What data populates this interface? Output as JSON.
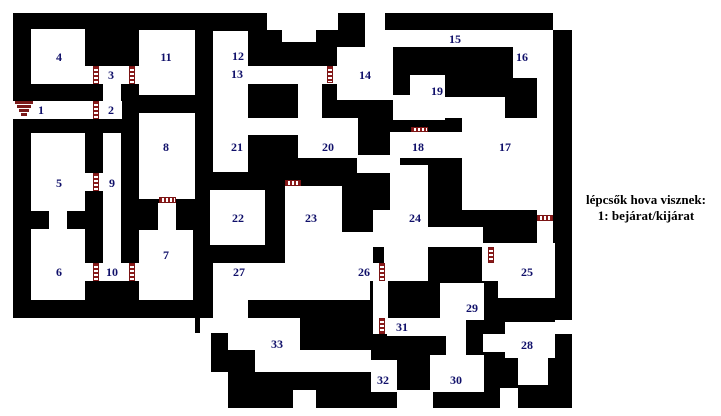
{
  "map": {
    "wall_color": "#000000",
    "floor_color": "#ffffff",
    "label_color": "#10106a",
    "door_color": "#8b1a1a",
    "stairs_color": "#7a1a1a",
    "walls": [
      [
        13,
        13,
        559,
        305
      ],
      [
        195,
        318,
        377,
        54
      ],
      [
        228,
        372,
        344,
        36
      ]
    ],
    "floors": [
      [
        31,
        29,
        54,
        55
      ],
      [
        85,
        66,
        54,
        18
      ],
      [
        103,
        84,
        18,
        18
      ],
      [
        13,
        101,
        109,
        18
      ],
      [
        139,
        30,
        56,
        65
      ],
      [
        139,
        113,
        56,
        86
      ],
      [
        158,
        203,
        18,
        27
      ],
      [
        31,
        133,
        54,
        78
      ],
      [
        49,
        211,
        18,
        18
      ],
      [
        31,
        229,
        54,
        71
      ],
      [
        103,
        133,
        18,
        148
      ],
      [
        85,
        173,
        18,
        18
      ],
      [
        85,
        263,
        54,
        18
      ],
      [
        139,
        230,
        54,
        70
      ],
      [
        213,
        31,
        35,
        141
      ],
      [
        248,
        66,
        97,
        18
      ],
      [
        337,
        47,
        56,
        53
      ],
      [
        365,
        30,
        188,
        17
      ],
      [
        513,
        47,
        40,
        31
      ],
      [
        537,
        78,
        16,
        40
      ],
      [
        248,
        118,
        69,
        17
      ],
      [
        298,
        84,
        24,
        36
      ],
      [
        298,
        118,
        60,
        40
      ],
      [
        357,
        155,
        43,
        18
      ],
      [
        390,
        132,
        72,
        26
      ],
      [
        393,
        95,
        52,
        25
      ],
      [
        410,
        75,
        35,
        20
      ],
      [
        445,
        97,
        60,
        21
      ],
      [
        462,
        118,
        91,
        92
      ],
      [
        537,
        210,
        16,
        37
      ],
      [
        210,
        190,
        55,
        55
      ],
      [
        285,
        186,
        57,
        79
      ],
      [
        342,
        232,
        31,
        33
      ],
      [
        213,
        263,
        166,
        18
      ],
      [
        213,
        281,
        157,
        19
      ],
      [
        373,
        281,
        15,
        53
      ],
      [
        387,
        318,
        59,
        18
      ],
      [
        384,
        245,
        44,
        36
      ],
      [
        390,
        165,
        38,
        82
      ],
      [
        373,
        210,
        17,
        37
      ],
      [
        428,
        227,
        55,
        20
      ],
      [
        482,
        243,
        16,
        20
      ],
      [
        482,
        263,
        22,
        18
      ],
      [
        498,
        243,
        57,
        55
      ],
      [
        440,
        283,
        44,
        37
      ],
      [
        446,
        320,
        20,
        36
      ],
      [
        430,
        355,
        54,
        37
      ],
      [
        505,
        322,
        50,
        36
      ],
      [
        518,
        358,
        30,
        27
      ],
      [
        483,
        334,
        22,
        18
      ],
      [
        228,
        318,
        72,
        32
      ],
      [
        200,
        318,
        28,
        15
      ],
      [
        255,
        350,
        45,
        22
      ],
      [
        298,
        350,
        73,
        22
      ],
      [
        371,
        360,
        26,
        32
      ],
      [
        213,
        298,
        35,
        35
      ],
      [
        267,
        13,
        71,
        17
      ],
      [
        282,
        30,
        34,
        12
      ],
      [
        365,
        13,
        20,
        17
      ],
      [
        553,
        13,
        19,
        17
      ],
      [
        293,
        390,
        23,
        18
      ],
      [
        500,
        388,
        18,
        20
      ],
      [
        555,
        320,
        17,
        14
      ],
      [
        397,
        390,
        36,
        18
      ],
      [
        195,
        333,
        16,
        39
      ]
    ],
    "doors": [
      [
        93,
        101,
        6,
        18,
        "v"
      ],
      [
        93,
        66,
        6,
        18,
        "v"
      ],
      [
        129,
        66,
        6,
        18,
        "v"
      ],
      [
        327,
        66,
        6,
        17,
        "v"
      ],
      [
        93,
        173,
        6,
        18,
        "v"
      ],
      [
        93,
        263,
        6,
        18,
        "v"
      ],
      [
        129,
        263,
        6,
        18,
        "v"
      ],
      [
        379,
        263,
        6,
        18,
        "v"
      ],
      [
        488,
        247,
        6,
        16,
        "v"
      ],
      [
        379,
        318,
        6,
        16,
        "v"
      ],
      [
        159,
        197,
        17,
        6,
        "h"
      ],
      [
        285,
        180,
        16,
        6,
        "h"
      ],
      [
        411,
        127,
        17,
        5,
        "h"
      ],
      [
        537,
        215,
        16,
        6,
        "h"
      ]
    ],
    "labels": [
      {
        "n": "1",
        "x": 41,
        "y": 110
      },
      {
        "n": "2",
        "x": 111,
        "y": 110
      },
      {
        "n": "3",
        "x": 111,
        "y": 75
      },
      {
        "n": "4",
        "x": 59,
        "y": 57
      },
      {
        "n": "5",
        "x": 59,
        "y": 183
      },
      {
        "n": "6",
        "x": 59,
        "y": 272
      },
      {
        "n": "7",
        "x": 166,
        "y": 255
      },
      {
        "n": "8",
        "x": 166,
        "y": 147
      },
      {
        "n": "9",
        "x": 112,
        "y": 183
      },
      {
        "n": "10",
        "x": 112,
        "y": 272
      },
      {
        "n": "11",
        "x": 166,
        "y": 57
      },
      {
        "n": "12",
        "x": 238,
        "y": 56
      },
      {
        "n": "13",
        "x": 237,
        "y": 74
      },
      {
        "n": "14",
        "x": 365,
        "y": 75
      },
      {
        "n": "15",
        "x": 455,
        "y": 39
      },
      {
        "n": "16",
        "x": 522,
        "y": 57
      },
      {
        "n": "17",
        "x": 505,
        "y": 147
      },
      {
        "n": "18",
        "x": 418,
        "y": 147
      },
      {
        "n": "19",
        "x": 437,
        "y": 91
      },
      {
        "n": "20",
        "x": 328,
        "y": 147
      },
      {
        "n": "21",
        "x": 237,
        "y": 147
      },
      {
        "n": "22",
        "x": 238,
        "y": 218
      },
      {
        "n": "23",
        "x": 311,
        "y": 218
      },
      {
        "n": "24",
        "x": 415,
        "y": 218
      },
      {
        "n": "25",
        "x": 527,
        "y": 272
      },
      {
        "n": "26",
        "x": 364,
        "y": 272
      },
      {
        "n": "27",
        "x": 239,
        "y": 272
      },
      {
        "n": "28",
        "x": 527,
        "y": 345
      },
      {
        "n": "29",
        "x": 472,
        "y": 308
      },
      {
        "n": "30",
        "x": 456,
        "y": 380
      },
      {
        "n": "31",
        "x": 402,
        "y": 327
      },
      {
        "n": "32",
        "x": 383,
        "y": 380
      },
      {
        "n": "33",
        "x": 277,
        "y": 344
      }
    ],
    "stairs": {
      "bars": [
        [
          15,
          101,
          18,
          3
        ],
        [
          17,
          105,
          14,
          3
        ],
        [
          19,
          109,
          10,
          3
        ],
        [
          21,
          113,
          6,
          3
        ]
      ]
    }
  },
  "legend": {
    "line1": "lépcsők hova visznek:",
    "line2": "1: bejárat/kijárat"
  }
}
